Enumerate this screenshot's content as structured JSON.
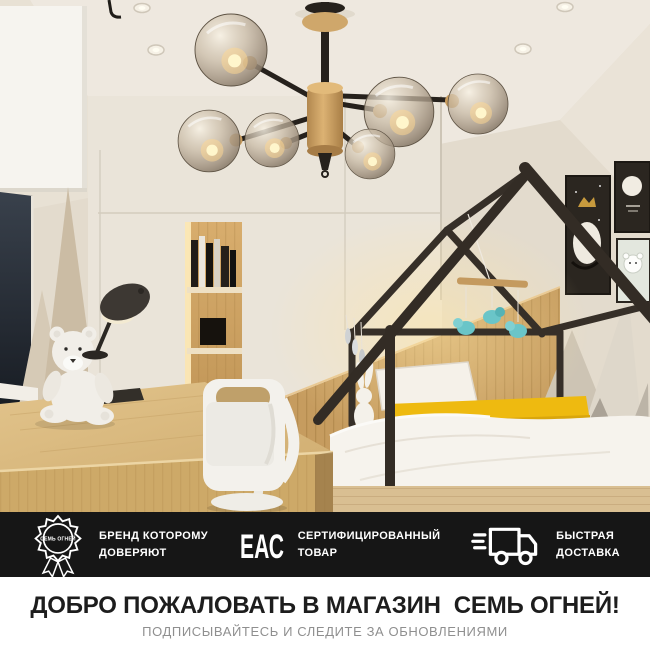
{
  "page": {
    "width": 650,
    "height": 650
  },
  "colors": {
    "badge_bar_bg": "#161616",
    "accent_yellow": "#eeba10",
    "wood": "#c79c5e",
    "teal_toys": "#6ac5c8",
    "wall_beige": "#e3dbcd",
    "frame_dark": "#342d26",
    "title_color": "#1d1d1d",
    "subtitle_color": "#8f8f8f"
  },
  "badge_bar": {
    "items": [
      {
        "icon": "brand-seal-icon",
        "seal_text": "СЕМЬ ОГНЕЙ",
        "lines": [
          "БРЕНД КОТОРОМУ",
          "ДОВЕРЯЮТ"
        ]
      },
      {
        "icon": "eac-mark-icon",
        "mark_text": "ЕАС",
        "lines": [
          "СЕРТИФИЦИРОВАННЫЙ",
          "ТОВАР"
        ]
      },
      {
        "icon": "delivery-truck-icon",
        "lines": [
          "БЫСТРАЯ",
          "ДОСТАВКА"
        ]
      }
    ]
  },
  "footer": {
    "title": "ДОБРО ПОЖАЛОВАТЬ В МАГАЗИН  СЕМЬ ОГНЕЙ!",
    "subtitle": "ПОДПИСЫВАЙТЕСЬ И СЛЕДИТЕ ЗА ОБНОВЛЕНИЯМИ"
  }
}
